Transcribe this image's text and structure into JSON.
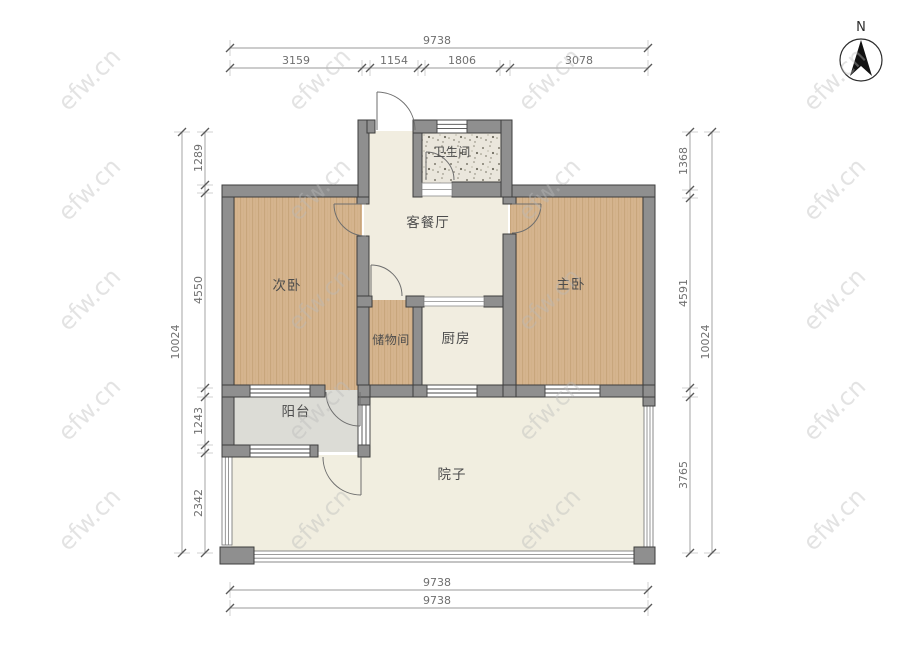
{
  "plan": {
    "type": "apartment-floor-plan",
    "rooms": {
      "bathroom": "卫生间",
      "living_dining": "客餐厅",
      "secondary_bedroom": "次卧",
      "master_bedroom": "主卧",
      "storage": "储物间",
      "kitchen": "厨房",
      "balcony": "阳台",
      "courtyard": "院子"
    },
    "dimensions": {
      "top": {
        "overall": "9738",
        "segments": [
          "3159",
          "1154",
          "1806",
          "3078"
        ]
      },
      "left": {
        "overall": "10024",
        "segments": [
          "1289",
          "4550",
          "1243",
          "2342"
        ]
      },
      "right": {
        "overall": "10024",
        "segments": [
          "1368",
          "4591",
          "3765"
        ]
      },
      "bottom": {
        "lines": [
          "9738",
          "9738"
        ]
      }
    },
    "north": {
      "label": "N"
    },
    "watermark": {
      "text": "efw.cn"
    },
    "colors": {
      "wall": "#8F8F8F",
      "wall_outline": "#3D3D3D",
      "wood_floor": "#D5B48E",
      "wood_grain": "#C2A074",
      "cream_floor": "#F1EDE0",
      "bathroom_floor": "#EAE6DC",
      "balcony_floor": "#DCDCD6",
      "courtyard_floor": "#F1EEE0",
      "dimension_text": "#6F6F6F"
    }
  }
}
